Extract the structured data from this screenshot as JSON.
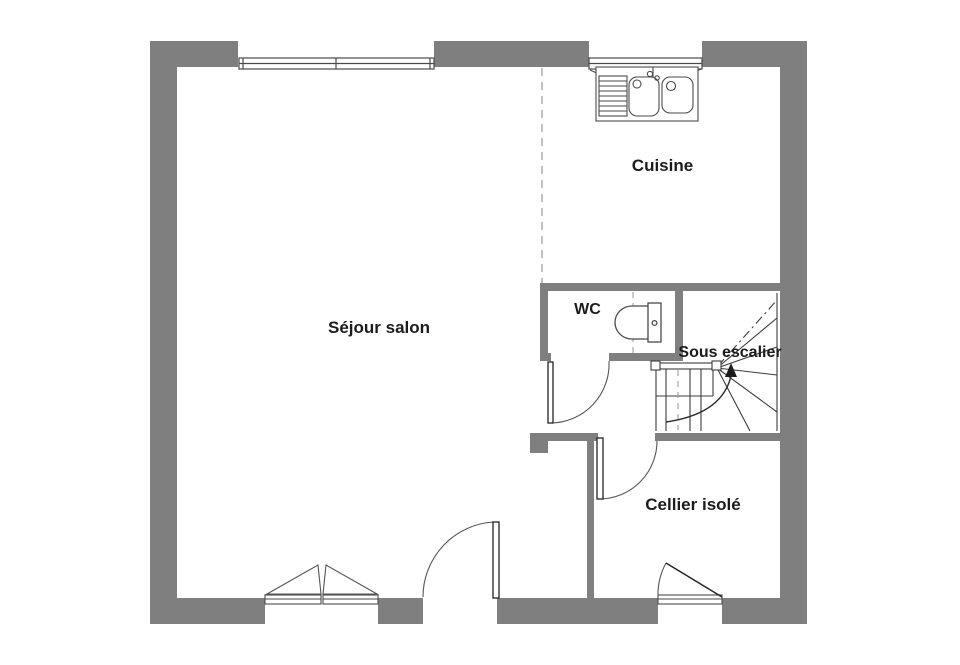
{
  "plan": {
    "type": "floor-plan",
    "colors": {
      "wall": "#7f7f7f",
      "fixture_line": "#4a4a4a",
      "door_line": "#2b2b2b",
      "dashed_line": "#b0b0b0",
      "text": "#1c1c1c",
      "background": "#ffffff"
    },
    "rooms": {
      "sejour": {
        "label": "Séjour salon"
      },
      "cuisine": {
        "label": "Cuisine"
      },
      "wc": {
        "label": "WC"
      },
      "sous_escalier": {
        "label": "Sous escalier"
      },
      "cellier": {
        "label": "Cellier isolé"
      }
    },
    "fixtures": {
      "sink": "double-sink-with-drainboard-icon",
      "toilet": "toilet-icon",
      "staircase": "winder-staircase-icon",
      "windows": [
        "double-casement-window",
        "kitchen-window"
      ],
      "doors": [
        "wc-door",
        "cellier-door",
        "sejour-door",
        "entrance-door",
        "french-window"
      ]
    }
  }
}
